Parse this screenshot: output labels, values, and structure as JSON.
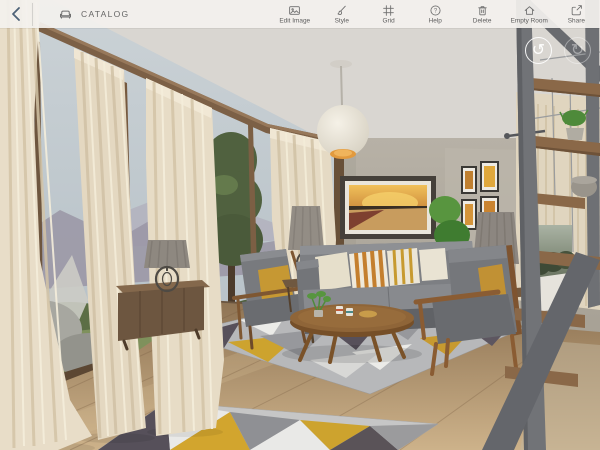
{
  "toolbar": {
    "back_icon": "chevron-left",
    "catalog_icon": "sofa",
    "catalog_label": "CATALOG",
    "tools": [
      {
        "label": "Edit Image",
        "icon": "image"
      },
      {
        "label": "Style",
        "icon": "paintbrush"
      },
      {
        "label": "Grid",
        "icon": "grid-frame"
      },
      {
        "label": "Help",
        "icon": "question-circle"
      },
      {
        "label": "Delete",
        "icon": "trash"
      },
      {
        "label": "Empty Room",
        "icon": "house"
      },
      {
        "label": "Share",
        "icon": "share-box"
      }
    ]
  },
  "canvas": {
    "undo_icon": "undo-arrow",
    "redo_icon": "redo-arrow"
  },
  "glyphs": {
    "help_qmark": "?",
    "undo": "↺",
    "redo": "↻"
  },
  "palette": {
    "toolbar_bg": "#f2f0ed",
    "toolbar_icon": "#6e6e6e",
    "back_chevron": "#4e6277",
    "ceiling": "#d7d4cf",
    "wall": "#b1aba0",
    "curtain": "#e6dbc6",
    "floor_wood": "#b3946c",
    "sofa_gray": "#7d7f83",
    "accent_mustard": "#c79a30",
    "chair_wood": "#8a5c33",
    "stair_metal": "#6e7074",
    "stair_tread": "#8a6848",
    "pendant_glow": "#e29a3e",
    "plant_green": "#58953f"
  }
}
